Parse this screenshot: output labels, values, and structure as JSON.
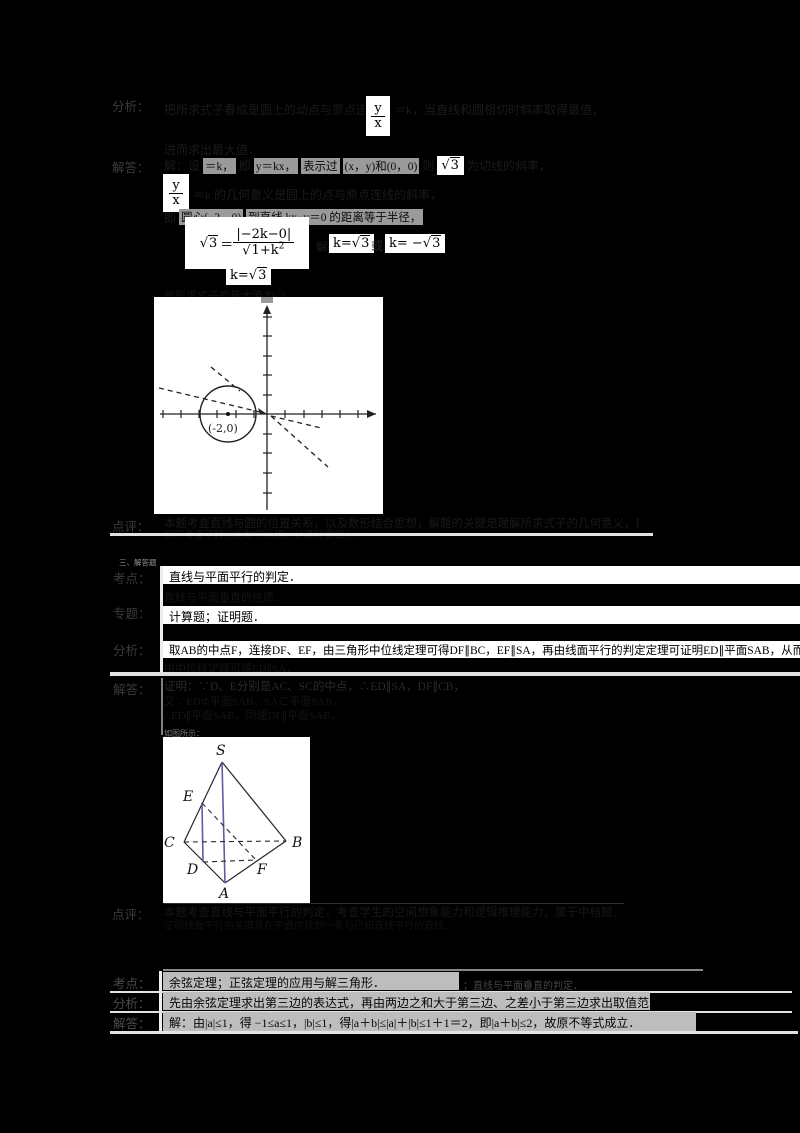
{
  "colors": {
    "page_bg": "#000000",
    "formula_box_bg": "#ffffff",
    "row_band_bg": "#ffffff",
    "gray_band_bg": "#bdbdbd",
    "chip_bg": "#9a9a9a",
    "faint_text": "#1a1a1a",
    "label_text": "#3b3b3b",
    "separator_line": "#e2e2e2",
    "figure_accent_line": "#5d5da0",
    "figure_ink": "#222222"
  },
  "p1": {
    "analysis": {
      "label": "分析：",
      "l1a": "把所求式子看成是圆上的动点与原点连线的斜率，设",
      "frac_num": "y",
      "frac_den": "x",
      "l1b": "＝k，当直线和圆相切时斜率取得最值，",
      "l2": "进而求出最大值．"
    },
    "answer": {
      "label": "解答：",
      "l1a": "解：设",
      "c1": "＝k，",
      "l1b": "即",
      "c2": "y＝kx，",
      "c3": "表示过",
      "c4": "(x，y)和(0，0)",
      "l1c": "则",
      "sqrt3": "3",
      "l1d": "为切线的斜率，",
      "frac_num": "y",
      "frac_den": "x",
      "l2": "＝k 的几何意义是圆上的点与原点连线的斜率，",
      "l3a": "即",
      "l3c1": "圆心(−2，0)",
      "l3c2": "到直线 kx−y＝0 的距离等于半径，",
      "f_lhs_rad": "3",
      "f_eq": "＝",
      "f_num": "|−2k−0|",
      "f_den_rad": "1+k",
      "f_den_sup": "2",
      "jiede": "解得",
      "k1_pre": "k=",
      "k1_rad": "3",
      "or_text": "或",
      "k2_pre": "k= −",
      "k2_rad": "3",
      "k3_pre": "k=",
      "k3_rad": "3",
      "l4": "故所求式子的最大值为√3．"
    },
    "graph": {
      "coord_label": "(-2,0)"
    },
    "comment": {
      "label": "点评：",
      "l1": "本题考查直线与圆的位置关系，以及数形结合思想，解题的关键是理解所求式子的几何意义，属于中档题．",
      "l2": "同时考查了转化的数学思想，计算时要细心．"
    }
  },
  "p2": {
    "section_header": "三、解答题",
    "kaodian": {
      "label": "考点：",
      "text": "直线与平面平行的判定．",
      "text2": "直线与平面垂直的性质．"
    },
    "zhuanti": {
      "label": "专题：",
      "text": "计算题；证明题．"
    },
    "fenxi": {
      "label": "分析：",
      "l1": "取AB的中点F，连接DF、EF，由三角形中位线定理可得DF∥BC，EF∥SA，再由线面平行的判定定理可证明ED∥平面SAB，从而得出结论．",
      "l2": "由中位线定理可得ED∥SA．"
    },
    "jieda": {
      "label": "解答：",
      "l1": "证明：∵D、E分别是AC、SC的中点，∴ED∥SA，DF∥CB，",
      "l2": "又∵ED⊄平面SAB，SA⊂平面SAB，",
      "l3": "∴ED∥平面SAB，同理DF∥平面SAB，",
      "figure_note": "如图所示："
    },
    "dianping": {
      "label": "点评：",
      "l1": "本题考查直线与平面平行的判定，考查学生的空间想象能力和逻辑推理能力，属于中档题．",
      "l2": "证明线面平行的关键是在平面内找到一条与已知直线平行的直线．"
    },
    "figure": {
      "S": "S",
      "E": "E",
      "C": "C",
      "B": "B",
      "D": "D",
      "F": "F",
      "A": "A"
    }
  },
  "p3": {
    "kaodian": {
      "label": "考点：",
      "text": "余弦定理；正弦定理的应用与解三角形．",
      "text2": "；直线与平面垂直的判定．"
    },
    "fenxi": {
      "label": "分析：",
      "text": "先由余弦定理求出第三边的表达式，再由两边之和大于第三边、之差小于第三边求出取值范围，可求解本题．"
    },
    "jieda": {
      "label": "解答：",
      "text": "解：由|a|≤1，得 −1≤a≤1，|b|≤1，得|a＋b|≤|a|＋|b|≤1＋1＝2，即|a＋b|≤2，故原不等式成立．"
    }
  }
}
